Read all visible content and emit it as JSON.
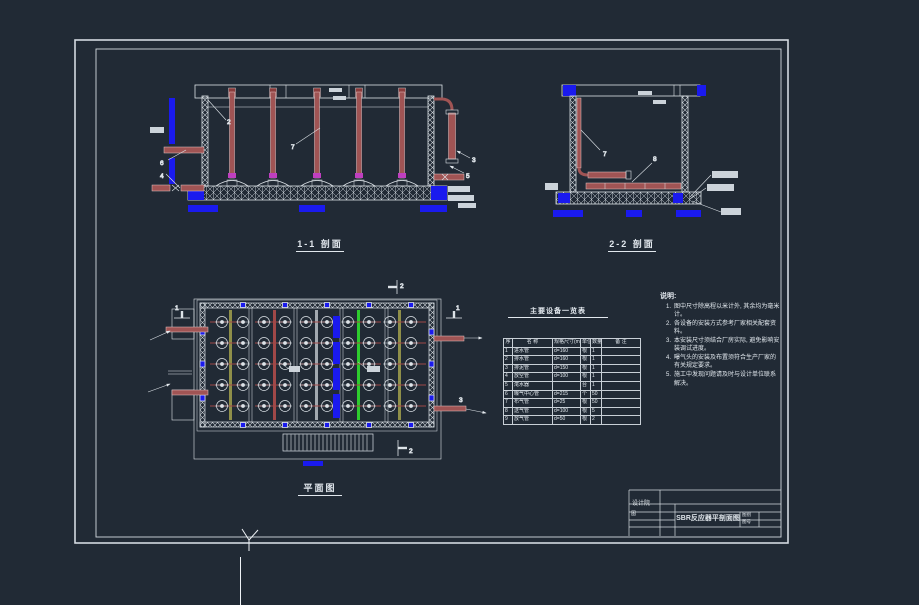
{
  "colors": {
    "background": "#212a35",
    "line": "#dde3e8",
    "dimension_blue": "#1a1aee",
    "pipe_red": "#a05454",
    "coupling_magenta": "#bf3fbf",
    "pipe_green": "#2ecc2e",
    "pipe_olive": "#8f8f49",
    "label_tag_fill": "#ccd3da"
  },
  "views": {
    "section11": {
      "title": "1-1 剖面"
    },
    "section22": {
      "title": "2-2 剖面"
    },
    "plan": {
      "title": "平面图"
    }
  },
  "callouts": {
    "s11_2": "2",
    "s11_7": "7",
    "s11_3": "3",
    "s11_5": "5",
    "s11_6": "6",
    "s11_4": "4",
    "s22_7": "7",
    "s22_8": "8",
    "plan_1_left": "1",
    "plan_1_right": "1",
    "plan_2_top": "2",
    "plan_2_bottom": "2",
    "plan_3": "3"
  },
  "table": {
    "title": "主要设备一览表",
    "headers": [
      "序",
      "名  称",
      "规格尺寸(mm)",
      "单位",
      "数量",
      "备 注"
    ],
    "rows": [
      [
        "1",
        "进水管",
        "d=160",
        "根",
        "1",
        ""
      ],
      [
        "2",
        "排水管",
        "d=160",
        "根",
        "1",
        ""
      ],
      [
        "3",
        "排泥管",
        "d=150",
        "根",
        "1",
        ""
      ],
      [
        "4",
        "放空管",
        "d=100",
        "根",
        "1",
        ""
      ],
      [
        "5",
        "滗水器",
        "",
        "台",
        "1",
        ""
      ],
      [
        "6",
        "曝气中心管",
        "d=215",
        "个",
        "50",
        ""
      ],
      [
        "7",
        "布气管",
        "d=25",
        "根",
        "50",
        ""
      ],
      [
        "8",
        "送气管",
        "d=100",
        "根",
        "5",
        ""
      ],
      [
        "9",
        "放气管",
        "d=50",
        "根",
        "2",
        ""
      ]
    ]
  },
  "notes": {
    "title": "说明:",
    "items": [
      "图中尺寸除高程以米计外, 其余均为毫米计。",
      "各设备的安装方式参考厂家相关配套资料。",
      "本安装尺寸须结合厂房实际, 避免影响安装调试进度。",
      "曝气头的安装及布置须符合生产厂家的有关规定要求。",
      "施工中发现问题请及时与设计单位联系解决。"
    ]
  },
  "titleblock": {
    "org": "设计院",
    "fig": "图",
    "title": "SBR反应器平剖面图",
    "sheet_type_label": "图别",
    "sheet_no_label": "图号"
  }
}
